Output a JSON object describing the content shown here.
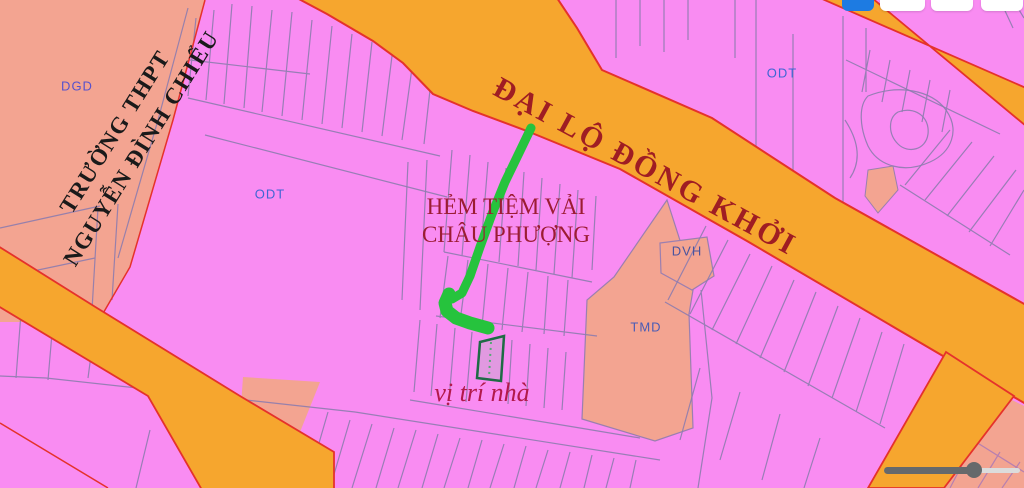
{
  "map": {
    "road_label": "ĐẠI LỘ ĐỒNG KHỞI",
    "school_label_line1": "TRƯỜNG THPT",
    "school_label_line2": "NGUYỄN ĐÌNH CHIỂU",
    "alley_label_line1": "HẺM TIỆM VẢI",
    "alley_label_line2": "CHÂU PHƯỢNG",
    "house_label": "vị trí nhà",
    "zones": {
      "dgd": "DGD",
      "odt_left": "ODT",
      "odt_right": "ODT",
      "dvh": "DVH",
      "tmd": "TMD"
    }
  },
  "toolbar": {
    "buttons": [
      "primary-button-cutoff",
      "panel-button-cutoff",
      "panel-button-cutoff",
      "panel-button-cutoff"
    ]
  },
  "slider": {
    "value_percent": 66
  },
  "colors": {
    "parcel_pink": "#F98CF2",
    "zone_salmon": "#F3A491",
    "road_orange": "#F6A62E",
    "road_border_red": "#E5322B",
    "parcel_line_purple": "#8D7CAE",
    "route_green": "#26C33D",
    "highlight_parcel_green": "#1E6B45",
    "label_dark_red": "#9F1D23",
    "label_crimson": "#B2194A",
    "zone_label_blue": "#3F66D4",
    "button_blue": "#1D7BE2"
  }
}
